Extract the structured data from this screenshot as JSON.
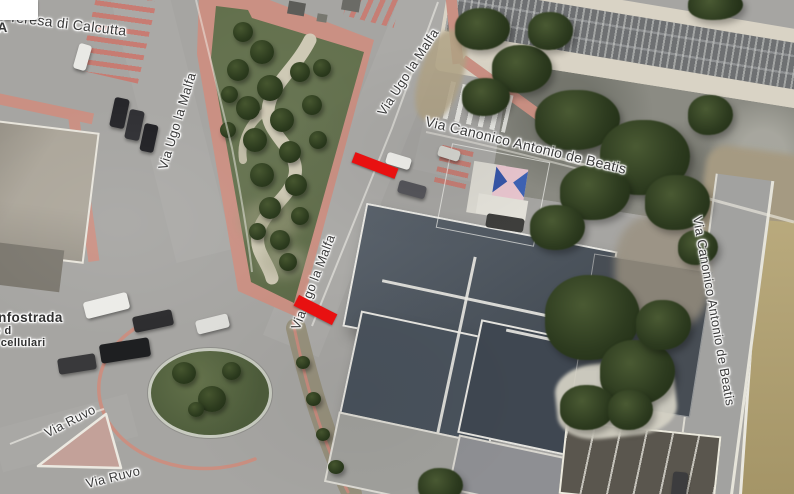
{
  "canvas": {
    "width": 794,
    "height": 494,
    "view": "satellite-map"
  },
  "map": {
    "street_labels": {
      "teresa_di_calcutta": "de Teresa di Calcutta",
      "edge_partial": "IA",
      "via_ugo_la_malfa_west": "Via Ugo la Malfa",
      "via_ugo_la_malfa_north": "Via Ugo la Malfa",
      "via_ugo_la_malfa_mid": "Via Ugo la Malfa",
      "via_canonico_horizontal": "Via Canonico Antonio de Beatis",
      "via_canonico_vertical": "Via Canonico Antonio de Beatis",
      "via_ruvo_upper": "Via Ruvo",
      "via_ruvo_lower": "Via Ruvo"
    },
    "poi": {
      "name": "Infostrada",
      "detail_line_1": "o d",
      "detail_line_2": "i cellulari"
    },
    "annotations": {
      "marker_color": "#e81111",
      "markers": [
        {
          "id": "road-block-north",
          "shape": "red-bar"
        },
        {
          "id": "road-block-south",
          "shape": "red-bar"
        }
      ]
    },
    "colors": {
      "asphalt": "#a6a5a2",
      "grass": "#5c6a45",
      "pink_pavement": "#ca9083",
      "roof_dark": "#4c555f",
      "rail_bed": "#d9d3c5",
      "field_tan": "#b1a06e"
    }
  }
}
